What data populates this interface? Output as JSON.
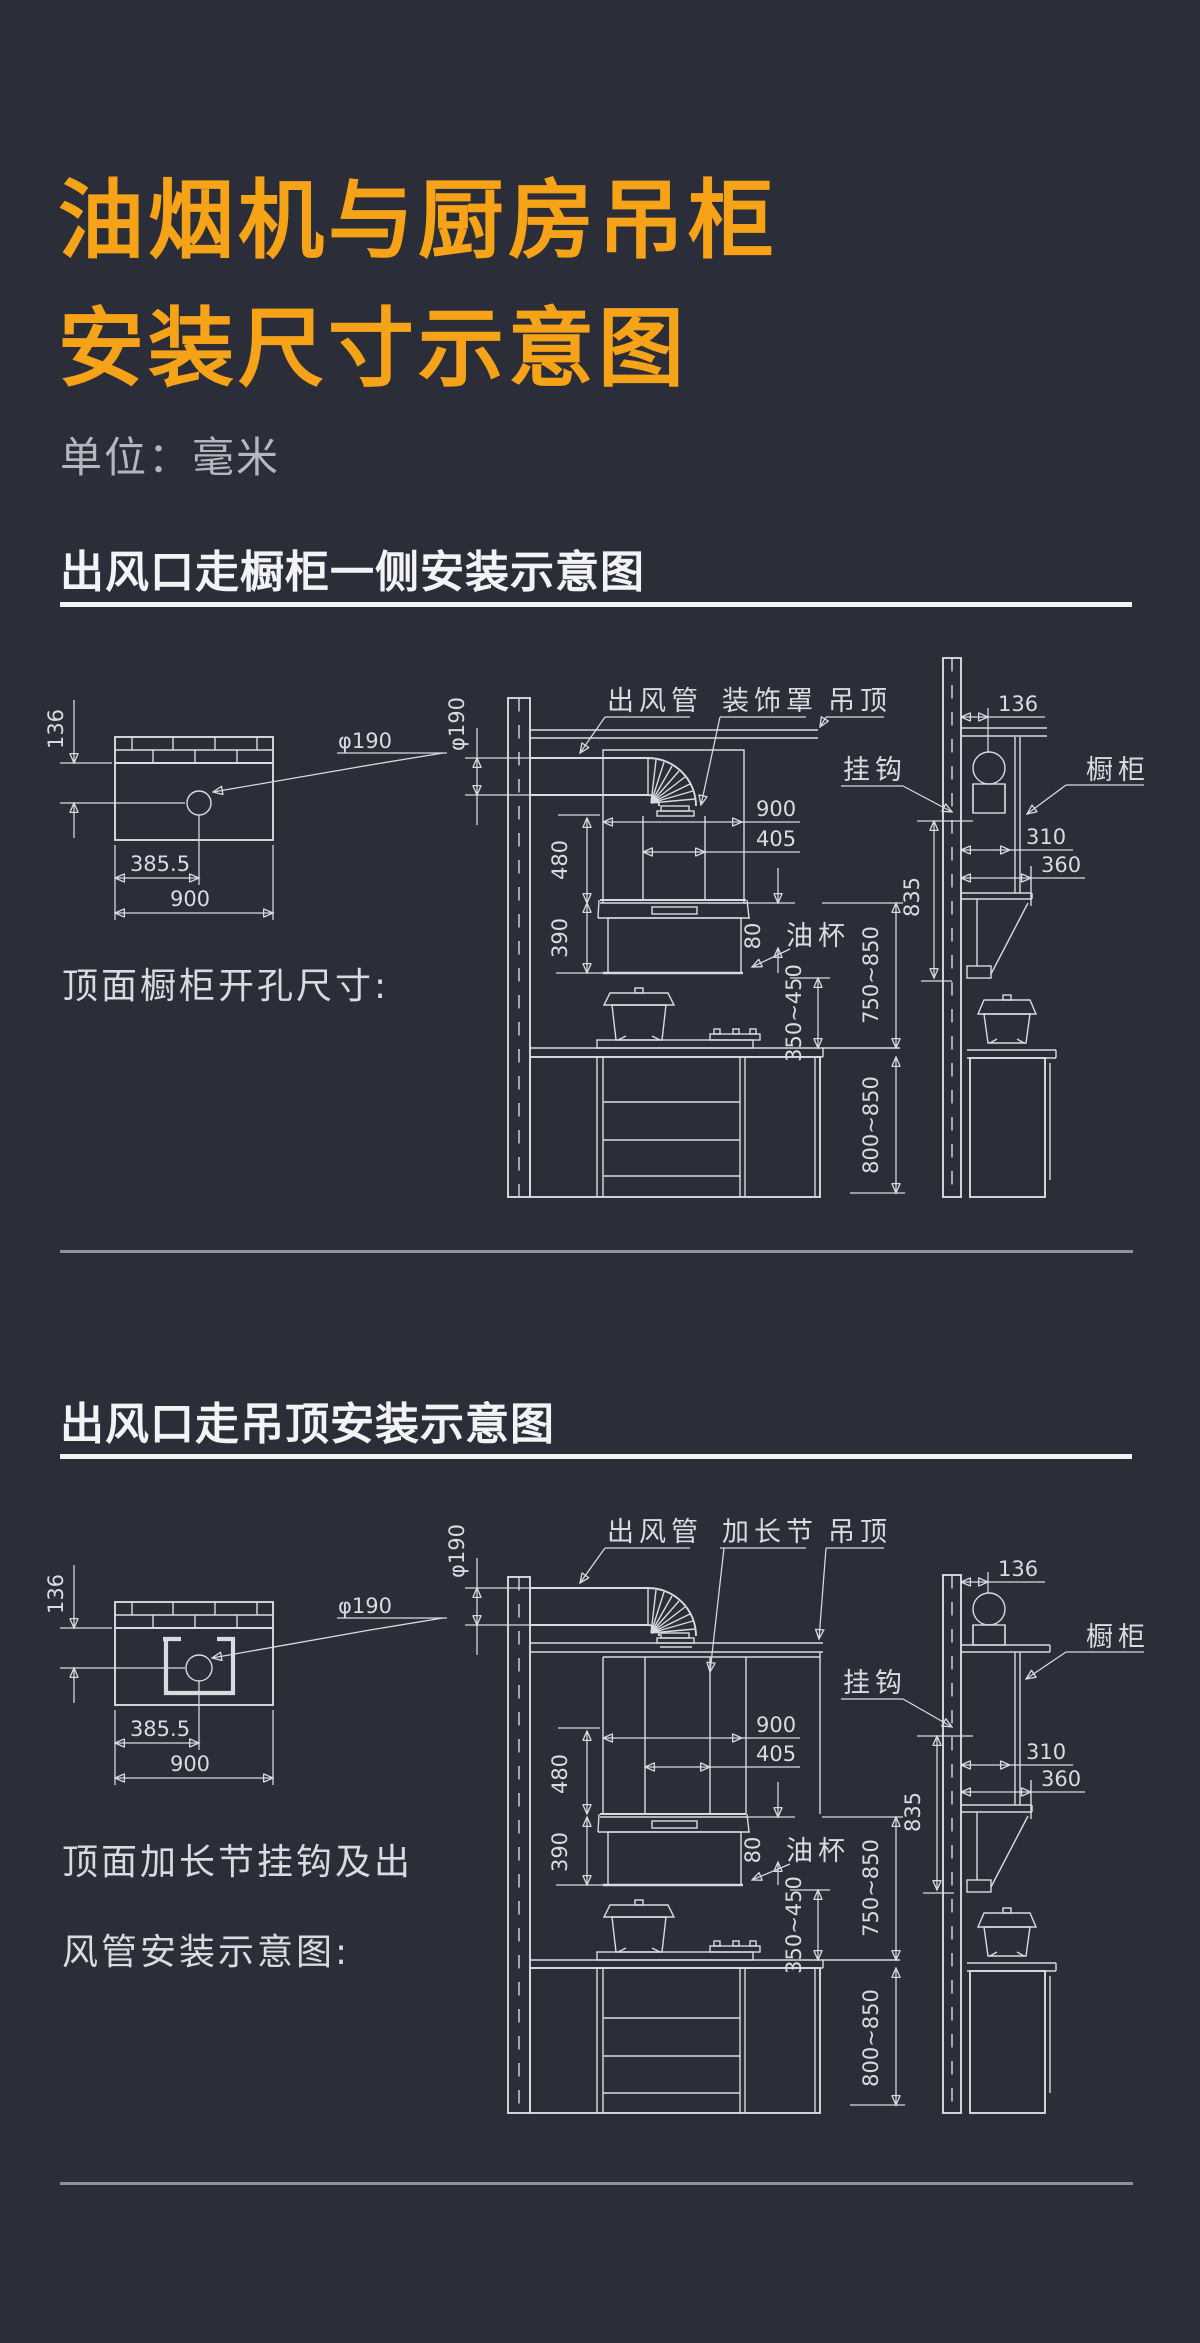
{
  "colors": {
    "background": "#2b2d39",
    "line": "#d9dbe1",
    "accent": "#f6a317",
    "muted_text": "#b3b7c0",
    "divider": "#8e929d"
  },
  "title": {
    "line1": "油烟机与厨房吊柜",
    "line2": "安装尺寸示意图"
  },
  "unit_label": "单位：毫米",
  "section1": {
    "heading": "出风口走橱柜一侧安装示意图",
    "caption": "顶面橱柜开孔尺寸:",
    "labels": {
      "duct": "出风管",
      "cover": "装饰罩",
      "ceiling": "吊顶",
      "hook": "挂钩",
      "cabinet": "橱柜",
      "oil_cup": "油杯"
    },
    "dims": {
      "d136": "136",
      "dia190": "φ190",
      "d385_5": "385.5",
      "d900": "900",
      "d405": "405",
      "d480": "480",
      "d390": "390",
      "d80": "80",
      "d350_450": "350~450",
      "d750_850": "750~850",
      "d800_850": "800~850",
      "d835": "835",
      "d310": "310",
      "d360": "360"
    }
  },
  "section2": {
    "heading": "出风口走吊顶安装示意图",
    "caption_line1": "顶面加长节挂钩及出",
    "caption_line2": "风管安装示意图:",
    "labels": {
      "duct": "出风管",
      "extension": "加长节",
      "ceiling": "吊顶",
      "hook": "挂钩",
      "cabinet": "橱柜",
      "oil_cup": "油杯"
    },
    "dims": {
      "d136": "136",
      "dia190": "φ190",
      "d385_5": "385.5",
      "d900": "900",
      "d405": "405",
      "d480": "480",
      "d390": "390",
      "d80": "80",
      "d350_450": "350~450",
      "d750_850": "750~850",
      "d800_850": "800~850",
      "d835": "835",
      "d310": "310",
      "d360": "360"
    }
  }
}
